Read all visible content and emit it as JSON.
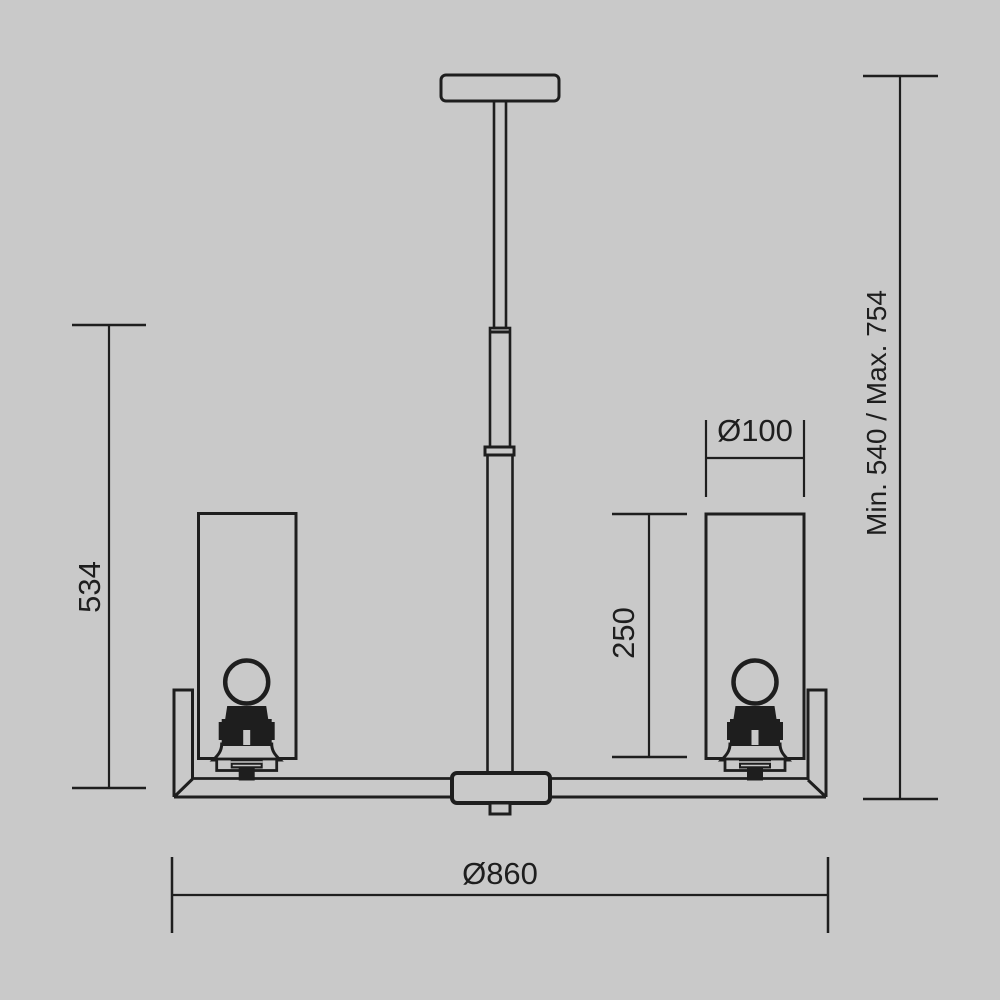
{
  "page": {
    "background_color": "#c9c9c9",
    "line_color": "#1e1e1e"
  },
  "drawing": {
    "title": "Chandelier technical dimension drawing, side view",
    "labels": {
      "height_left": "534",
      "suspension_range": "Min. 540 / Max. 754",
      "shade_diameter": "Ø100",
      "shade_height": "250",
      "fixture_diameter": "Ø860"
    }
  }
}
